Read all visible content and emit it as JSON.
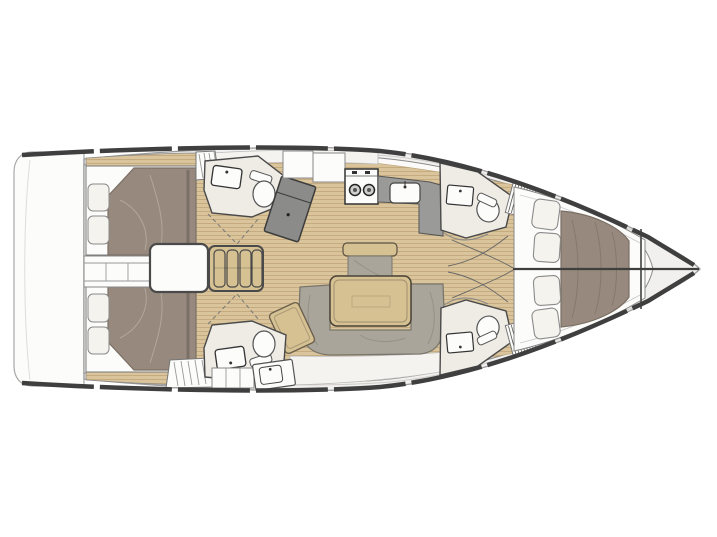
{
  "palette": {
    "page_bg": "#ffffff",
    "deck": "#f1f0ee",
    "interior": "#fbfaf8",
    "room_floor": "#efece6",
    "wood": "#d9c49b",
    "wood_line": "#c3a87c",
    "table_wood": "#d6c193",
    "upholstery": "#97897d",
    "upholstery_line": "#7b6f63",
    "sofa": "#a9a59b",
    "sofa_line": "#7b776d",
    "counter": "#9a9a98",
    "nav_table": "#8b8b89",
    "pillow": "#f5f3ee",
    "outline": "#4a4a4a",
    "rail": "#3f3f3f",
    "hull_line": "#9b9b9b"
  }
}
